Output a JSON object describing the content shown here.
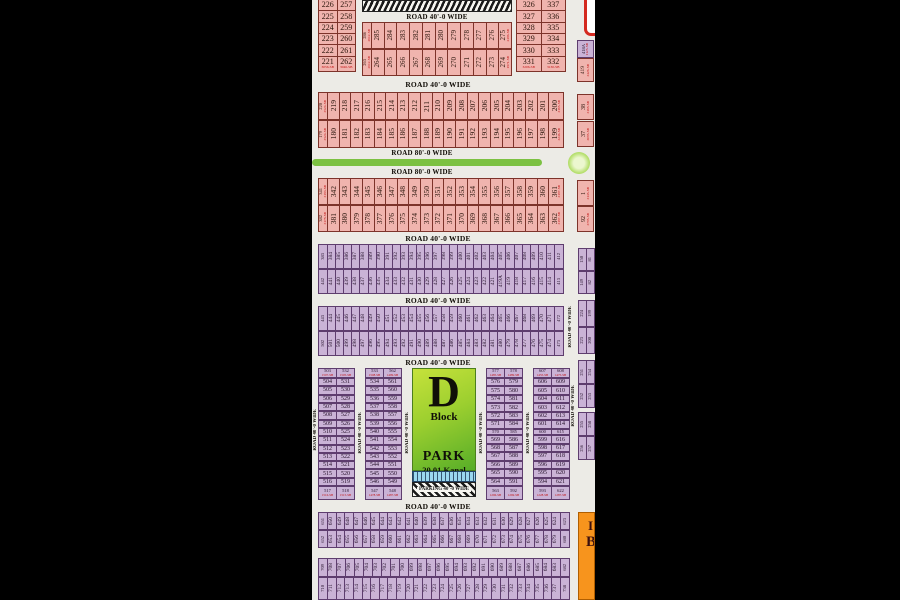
{
  "scene": {
    "bg": "#000000"
  },
  "palette": {
    "pink": "#F0B4AE",
    "pink_border": "#7D332A",
    "purple": "#CAB3D6",
    "purple_border": "#5E3D6E",
    "red_text": "#C21111",
    "map_bg": "#ECEBE6",
    "green_road": "#7CC142",
    "orange": "#F7941D",
    "park_green_light": "#C6E23B",
    "park_green_dark": "#57AD28",
    "parking_blue": "#9AD7EF"
  },
  "labels": {
    "road40": "ROAD 40'-0 WIDE",
    "road80": "ROAD 80'-0 WIDE",
    "parking": "PARKING 40'-0 WIDE"
  },
  "park": {
    "letter": "D",
    "block": "Block",
    "name": "PARK",
    "area": "20.01 Kanal"
  },
  "orange_text": {
    "line1": "I",
    "line2": "B"
  },
  "band1": {
    "left": {
      "pairs": [
        [
          "226",
          "257"
        ],
        [
          "225",
          "258"
        ],
        [
          "224",
          "259"
        ],
        [
          "223",
          "260"
        ],
        [
          "222",
          "261"
        ],
        [
          "221",
          "262"
        ]
      ],
      "last_sqft": [
        "3056-SB",
        "3046-SB"
      ]
    },
    "mid": {
      "row1": {
        "corner": "286",
        "corner_sqft": "2612-SB",
        "plots": [
          "285..275"
        ],
        "last_sqft": "2496-SB"
      },
      "row2": {
        "corner": "263",
        "corner_sqft": "2612-SB",
        "plots": [
          "264..274"
        ],
        "last_sqft": "1971-SB"
      }
    },
    "right": {
      "pairs": [
        [
          "326",
          "337"
        ],
        [
          "327",
          "336"
        ],
        [
          "328",
          "335"
        ],
        [
          "329",
          "334"
        ],
        [
          "330",
          "333"
        ],
        [
          "331",
          "332"
        ]
      ],
      "last_sqft": [
        "3206-SB",
        "3130-SB"
      ]
    },
    "frag_top": {
      "num": "418A",
      "sqft": "1125-SB"
    },
    "p419": {
      "num": "419",
      "sqft": "3426-SB"
    }
  },
  "band2": {
    "row1": {
      "corner": "220",
      "corner_sqft": "3524-SB",
      "plots": [
        "219..201"
      ],
      "last": "200",
      "last_sqft": "3165-SB"
    },
    "row2": {
      "corner": "179",
      "corner_sqft": "3524-SB",
      "plots": [
        "180..198"
      ],
      "last": "199",
      "last_sqft": "3246-SB"
    },
    "right": [
      {
        "num": "38",
        "sqft": "3168-SB"
      },
      {
        "num": "37",
        "sqft": "3085-SB"
      }
    ]
  },
  "band3": {
    "row1": {
      "corner": "341",
      "corner_sqft": "3183-SB",
      "plots": [
        "342..360"
      ],
      "last": "361",
      "last_sqft": "3187-SB"
    },
    "row2": {
      "corner": "382",
      "corner_sqft": "3178-SB",
      "plots": [
        "381..363"
      ],
      "last": "362",
      "last_sqft": "3187-SB"
    },
    "right": [
      {
        "num": "1",
        "sqft": "3145-SB"
      },
      {
        "num": "92",
        "sqft": "3785-SB"
      }
    ]
  },
  "band4": {
    "row1": {
      "corner": "383",
      "plots": [
        "384..411"
      ],
      "last": "412"
    },
    "row2": {
      "corner": "442",
      "plots": [
        "441..421",
        "419A",
        "419..414"
      ],
      "last": "413"
    }
  },
  "band5": {
    "row1": {
      "corner": "443",
      "plots": [
        "444..471"
      ],
      "last": "472"
    },
    "row2": {
      "corner": "502",
      "plots": [
        "501..474"
      ],
      "last": "473"
    }
  },
  "frags": {
    "f1": [
      [
        "150",
        "81"
      ],
      [
        "149",
        "82"
      ]
    ],
    "f2": [
      [
        "224",
        "199"
      ],
      [
        "223",
        "200"
      ]
    ],
    "f3": [
      [
        "251",
        "254"
      ],
      [
        "252",
        "253"
      ]
    ],
    "f4": [
      [
        "255",
        "258"
      ],
      [
        "256",
        "257"
      ]
    ]
  },
  "dblock": {
    "col1": {
      "header": [
        "503",
        "532"
      ],
      "header_sqft": [
        "1507-SB",
        "1505-SB"
      ],
      "rows": [
        [
          "504",
          "531"
        ],
        [
          "505",
          "530"
        ],
        [
          "506",
          "529"
        ],
        [
          "507",
          "528"
        ],
        [
          "508",
          "527"
        ],
        [
          "509",
          "526"
        ],
        [
          "510",
          "525"
        ],
        [
          "511",
          "524"
        ],
        [
          "512",
          "523"
        ],
        [
          "513",
          "522"
        ],
        [
          "514",
          "521"
        ],
        [
          "515",
          "520"
        ],
        [
          "516",
          "519"
        ]
      ],
      "footer": [
        "517",
        "518"
      ],
      "footer_sqft": [
        "1516-SB",
        "1515-SB"
      ]
    },
    "col2": {
      "header": [
        "533",
        "562"
      ],
      "header_sqft": [
        "1508-SB",
        "1499-SB"
      ],
      "rows": [
        [
          "534",
          "561"
        ],
        [
          "535",
          "560"
        ],
        [
          "536",
          "559"
        ],
        [
          "537",
          "558"
        ],
        [
          "538",
          "557"
        ],
        [
          "539",
          "556"
        ],
        [
          "540",
          "555"
        ],
        [
          "541",
          "554"
        ],
        [
          "542",
          "553"
        ],
        [
          "543",
          "552"
        ],
        [
          "544",
          "551"
        ],
        [
          "545",
          "550"
        ],
        [
          "546",
          "549"
        ]
      ],
      "footer": [
        "547",
        "548"
      ],
      "footer_sqft": [
        "1478-SB",
        "1487-SB"
      ]
    },
    "col3": {
      "header": [
        "577",
        "578"
      ],
      "header_sqft": [
        "1485-SB",
        "1489-SB"
      ],
      "rows": [
        [
          "576",
          "579"
        ],
        [
          "575",
          "580"
        ],
        [
          "574",
          "581"
        ],
        [
          "573",
          "582"
        ],
        [
          "572",
          "583"
        ],
        [
          "571",
          "584"
        ],
        [
          "570",
          "585",
          "sm"
        ],
        [
          "569",
          "586"
        ],
        [
          "568",
          "587"
        ],
        [
          "567",
          "588"
        ],
        [
          "566",
          "589"
        ],
        [
          "565",
          "590"
        ],
        [
          "564",
          "591"
        ]
      ],
      "footer": [
        "563",
        "592"
      ],
      "footer_sqft": [
        "1296-SB",
        "1269-SB"
      ]
    },
    "col4": {
      "header": [
        "607",
        "608"
      ],
      "header_sqft": [
        "1455-SB",
        "1475-SB"
      ],
      "rows": [
        [
          "606",
          "609"
        ],
        [
          "605",
          "610"
        ],
        [
          "604",
          "611"
        ],
        [
          "603",
          "612"
        ],
        [
          "602",
          "613"
        ],
        [
          "601",
          "614"
        ],
        [
          "600",
          "615",
          "sm"
        ],
        [
          "599",
          "616"
        ],
        [
          "598",
          "617"
        ],
        [
          "597",
          "618"
        ],
        [
          "596",
          "619"
        ],
        [
          "595",
          "620"
        ],
        [
          "594",
          "621"
        ]
      ],
      "footer": [
        "593",
        "622"
      ],
      "footer_sqft": [
        "1228-SB",
        "1287-SB"
      ]
    }
  },
  "band6": {
    "row1": {
      "corner": "651",
      "plots": [
        "650..624"
      ],
      "last": "623"
    },
    "row2": {
      "corner": "652",
      "plots": [
        "653..679"
      ],
      "last": "680"
    }
  },
  "band7": {
    "row1": {
      "corner": "709",
      "plots": [
        "708..683"
      ],
      "last": "682"
    },
    "row2": {
      "corner": "710",
      "plots": [
        "711..737"
      ],
      "last": "738"
    }
  }
}
